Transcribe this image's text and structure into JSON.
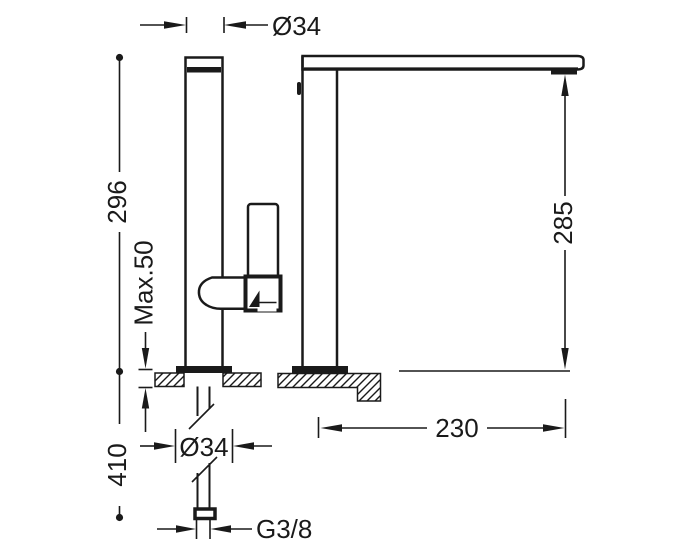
{
  "title": "faucet-technical-drawing",
  "colors": {
    "line": "#1a1a1a",
    "background": "#ffffff"
  },
  "dimensions": {
    "spout_outer_diameter": "Ø34",
    "body_height_above_deck": "296",
    "max_deck_thickness": "Max.50",
    "outlet_height": "285",
    "spout_reach": "230",
    "under_deck_length": "410",
    "base_diameter": "Ø34",
    "supply_thread": "G3/8"
  }
}
